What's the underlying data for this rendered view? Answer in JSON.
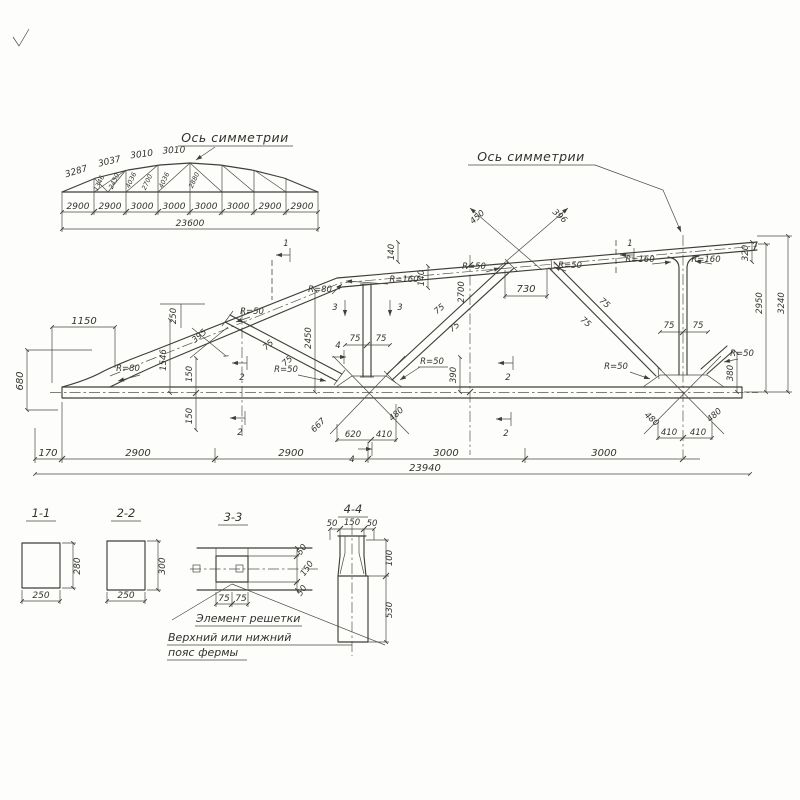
{
  "labels": {
    "symmetry": "Ось симметрии"
  },
  "overview": {
    "top_dims": [
      "3287",
      "3037",
      "3010",
      "3010"
    ],
    "web_dims": [
      "1346",
      "2450",
      "4036",
      "2700",
      "4036",
      "2880"
    ],
    "panel_dims": [
      "2900",
      "2900",
      "3000",
      "3000",
      "3000",
      "3000",
      "2900",
      "2900"
    ],
    "total": "23600"
  },
  "main": {
    "r": {
      "r50": "R=50",
      "r80": "R=80",
      "r160": "R=160"
    },
    "c": {
      "d75": "75",
      "d140": "140",
      "d150": "150",
      "d410": "410",
      "d480": "480"
    },
    "dims": {
      "d1150": "1150",
      "d680": "680",
      "d170": "170",
      "d2900": "2900",
      "d3000": "3000",
      "total": "23940",
      "d250": "250",
      "d395": "395",
      "d1546": "1546",
      "d2450": "2450",
      "d2700": "2700",
      "d730": "730",
      "d450": "450",
      "d396": "396",
      "d390": "390",
      "d667": "667",
      "d620": "620",
      "d380": "380",
      "d320": "320",
      "d2950": "2950",
      "d3240": "3240"
    },
    "marks": {
      "s1": "1",
      "s2": "2",
      "s3": "3",
      "s4": "4"
    }
  },
  "sections": {
    "s11": {
      "title": "1-1",
      "w": "250",
      "h": "280"
    },
    "s22": {
      "title": "2-2",
      "w": "250",
      "h": "300"
    },
    "s33": {
      "title": "3-3",
      "a": "75",
      "b": "75",
      "e1": "50",
      "e2": "150",
      "e3": "50"
    },
    "s44": {
      "title": "4-4",
      "t1": "50",
      "t2": "150",
      "t3": "50",
      "r1": "100",
      "r2": "530"
    },
    "notes": {
      "l1": "Элемент решетки",
      "l2": "Верхний или нижний",
      "l3": "пояс фермы"
    }
  }
}
